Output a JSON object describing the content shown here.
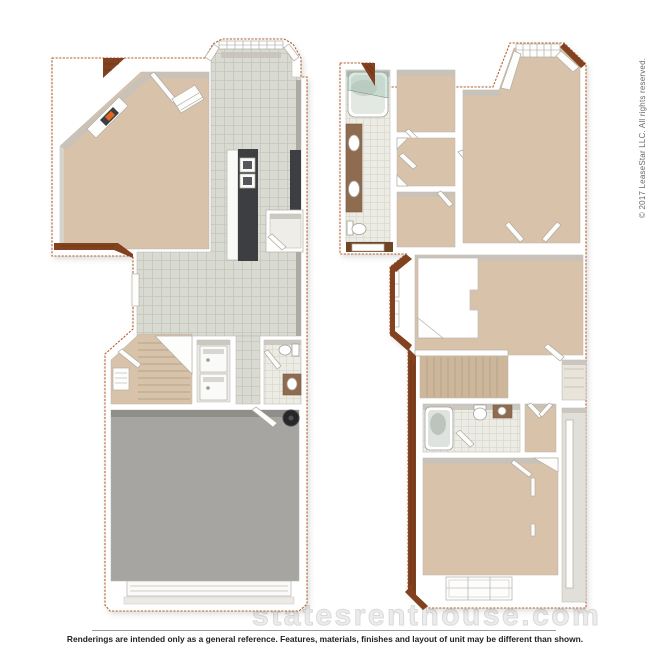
{
  "watermark": {
    "text": "statesrenthouse.com"
  },
  "copyright": {
    "text": "© 2017 LeaseStar LLC. All rights reserved."
  },
  "footer": {
    "disclaimer": "Renderings are intended only as a general reference. Features, materials, finishes and layout of unit may be different than shown."
  },
  "colors": {
    "outline": "#b4612f",
    "roof": "#82411f",
    "roof_dark": "#5f2e14",
    "carpet": "#d8c3aa",
    "carpet_dark": "#cdb699",
    "tile": "#d9dbd2",
    "tile_grid": "#c3c6b9",
    "bath_tile": "#ecece5",
    "bath_tile_grid": "#d7d7cd",
    "wall": "#ffffff",
    "wall_shade": "#c6c2bb",
    "wall_shade_dark": "#a9a59e",
    "garage_floor": "#a6a5a1",
    "counter_dark": "#3c3e41",
    "glass": "#9fc0b0",
    "vanity": "#8f6c50",
    "fire": "#e2661c",
    "appliance": "#fafaf8",
    "water_heater": "#27272a"
  }
}
